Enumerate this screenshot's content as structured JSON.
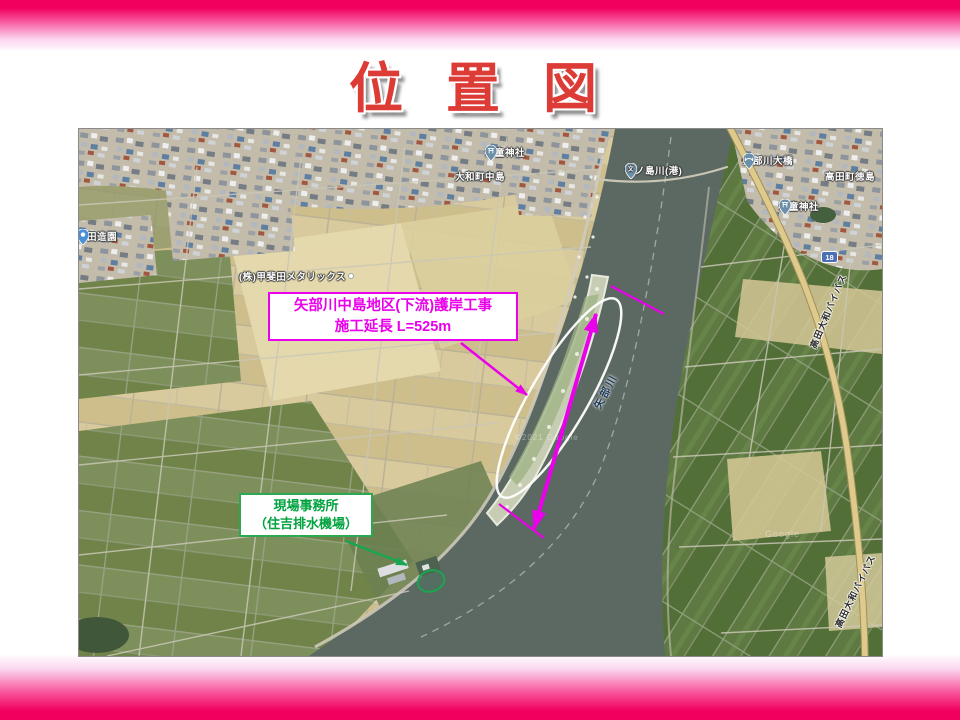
{
  "slide": {
    "title": "位 置 図"
  },
  "callouts": {
    "construction": {
      "line1": "矢部川中島地区(下流)護岸工事",
      "line2": "施工延長 L=525m",
      "color": "#EA00EA"
    },
    "office": {
      "line1": "現場事務所",
      "line2": "（住吉排水機場）",
      "color": "#00A33E"
    }
  },
  "map": {
    "labels": {
      "nishida_zoen": "西田造園",
      "kaida_metallics": "(株)甲斐田メタリックス",
      "yamatomachi_nakashima": "大和町中島",
      "kaido_shrine_1": "海童神社",
      "nakanoshima_port": "中ノ島川(港)",
      "yabegawa_ohashi": "矢部川大橋",
      "takatamachi_tokushima": "高田町徳島",
      "kaido_shrine_2": "海童神社",
      "yabe_river": "矢部川",
      "bypass_1": "高田大和バイパス",
      "bypass_2": "高田大和バイパス",
      "route_18": "18",
      "watermark_1": "©2021 Google",
      "watermark_2": "Google"
    },
    "icons": {
      "school_glyph": "文"
    }
  },
  "colors": {
    "accent_pink": "#F1005E",
    "annotation_magenta": "#EA00EA",
    "annotation_green": "#18A650",
    "title_red": "#DD3B35",
    "water": "#5C6963"
  }
}
